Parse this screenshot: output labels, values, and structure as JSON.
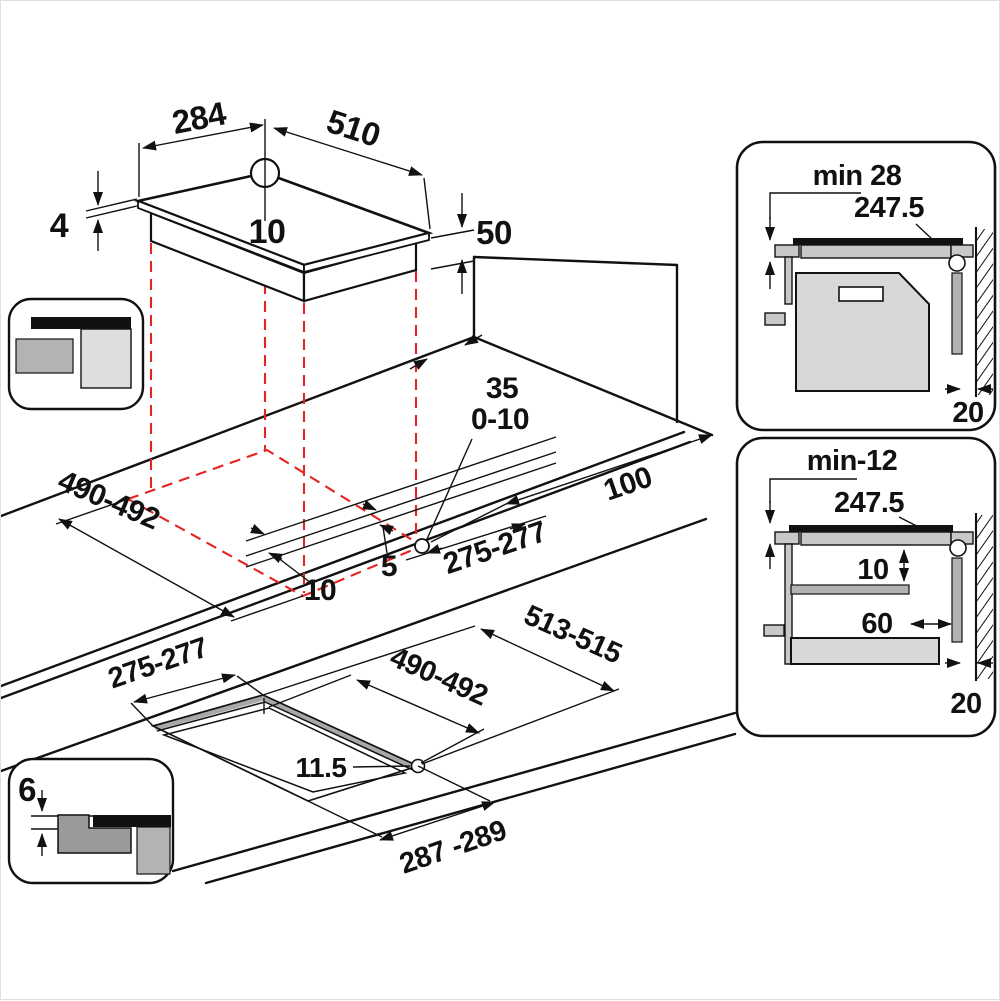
{
  "colors": {
    "line": "#111111",
    "cutout_dashed": "#e5231f",
    "gray_light": "#d8d8d8",
    "gray_mid": "#b3b3b3",
    "gray_dark": "#9a9a9a"
  },
  "top_view": {
    "depth": "284",
    "width": "510",
    "glass_thickness": "4",
    "rear_offset": "10",
    "body_depth": "50"
  },
  "worktop_view": {
    "cutout_length": "490-492",
    "cutout_width": "275-277",
    "edge_gap": "10",
    "bracket_gap": "5",
    "rear_clearance": "35",
    "hole_tolerance": "0-10",
    "right_clearance": "100"
  },
  "flush_view": {
    "cutout_width": "275-277",
    "outer_length": "513-515",
    "cutout_length": "490-492",
    "ledge_width": "11.5",
    "outer_width": "287 -289",
    "recess_depth": "6"
  },
  "detail_top": {
    "title": "min 28",
    "diagonal": "247.5",
    "wall_gap": "20"
  },
  "detail_bottom": {
    "title": "min-12",
    "diagonal": "247.5",
    "vent_gap": "10",
    "shelf_clearance": "60",
    "wall_gap": "20"
  }
}
